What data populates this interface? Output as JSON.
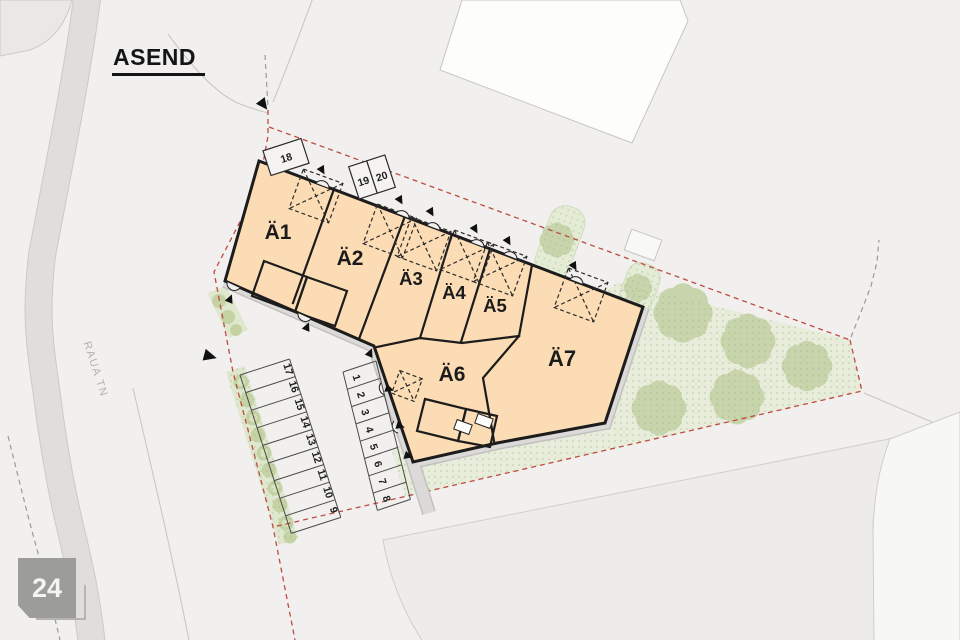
{
  "page": {
    "title": "ASEND",
    "street": "RAUA TN",
    "plot_badge": "24"
  },
  "units": [
    "Ä1",
    "Ä2",
    "Ä3",
    "Ä4",
    "Ä5",
    "Ä6",
    "Ä7"
  ],
  "parking": {
    "row_left": [
      "17",
      "16",
      "15",
      "14",
      "13",
      "12",
      "11",
      "10",
      "9"
    ],
    "row_right": [
      "1",
      "2",
      "3",
      "4",
      "5",
      "6",
      "7",
      "8"
    ],
    "row_top": [
      "18",
      "19",
      "20"
    ]
  },
  "colors": {
    "building": "#fbdcb4",
    "outline": "#1c1c1c",
    "green": "#e7edda",
    "tree": "#c8d4ab",
    "hedge": "#dfe8cf",
    "bush": "#c5d2a4",
    "boundary_red": "#bf4a40",
    "walkway": "#dbdad8",
    "road": "#dfdedc",
    "badge": "#9c9c9a"
  }
}
